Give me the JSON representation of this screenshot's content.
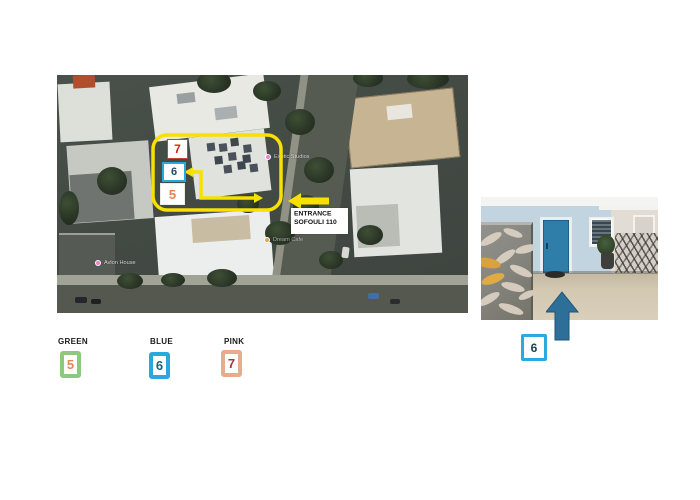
{
  "map": {
    "number_boxes": {
      "pink": "7",
      "blue": "6",
      "green": "5"
    },
    "entrance": {
      "line1": "ENTRANCE",
      "line2": "SOFOULI 110"
    },
    "labels": {
      "studios_label": "Exotic Studios",
      "avlon_label": "Avlon House",
      "dream_label": "Dream Cafe"
    }
  },
  "photo": {
    "badge": "6"
  },
  "legend": {
    "items": [
      {
        "label": "GREEN",
        "number": "5"
      },
      {
        "label": "BLUE",
        "number": "6"
      },
      {
        "label": "PINK",
        "number": "7"
      }
    ]
  },
  "colors": {
    "highlight_yellow": "#f8e000",
    "legend_green_border": "#8dc87e",
    "legend_blue_border": "#2aa7dd",
    "legend_pink_border": "#e9ab8e",
    "number_orange": "#e8854f",
    "number_teal": "#1a6275",
    "number_red": "#d42415",
    "number_dark_red": "#a33a2a",
    "up_arrow_blue": "#2d6f99",
    "door_blue": "#2f7ea9"
  }
}
